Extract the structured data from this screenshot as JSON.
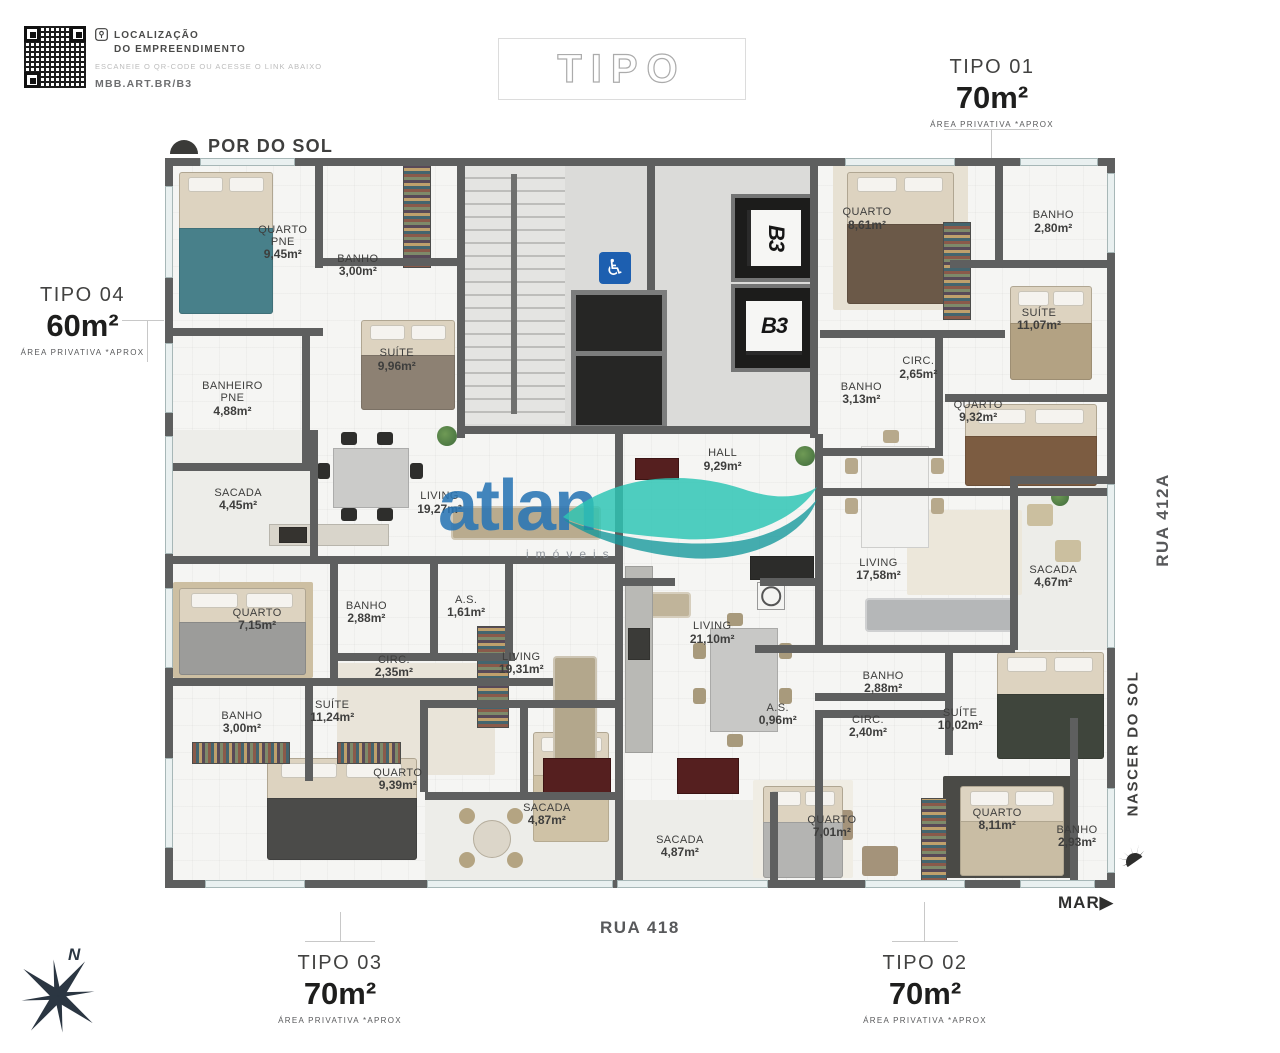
{
  "qr_block": {
    "title_line1": "LOCALIZAÇÃO",
    "title_line2": "DO EMPREENDIMENTO",
    "subtitle": "ESCANEIE O QR-CODE OU ACESSE O LINK ABAIXO",
    "link": "MBB.ART.BR/B3"
  },
  "plan_title": "TIPO",
  "unit_labels": {
    "tipo01": {
      "name": "TIPO 01",
      "area": "70m²",
      "note": "ÁREA PRIVATIVA *APROX"
    },
    "tipo02": {
      "name": "TIPO 02",
      "area": "70m²",
      "note": "ÁREA PRIVATIVA *APROX"
    },
    "tipo03": {
      "name": "TIPO 03",
      "area": "70m²",
      "note": "ÁREA PRIVATIVA *APROX"
    },
    "tipo04": {
      "name": "TIPO 04",
      "area": "60m²",
      "note": "ÁREA PRIVATIVA *APROX"
    }
  },
  "orientation": {
    "sunset_label": "POR DO SOL",
    "sunrise_label": "NASCER DO SOL",
    "sea_label": "MAR",
    "street_right": "RUA 412A",
    "street_bottom": "RUA 418",
    "compass_north": "N"
  },
  "core": {
    "elevator_brand": "B3",
    "accessible_icon": "wheelchair-symbol"
  },
  "watermark": {
    "brand": "atlan",
    "subtitle": "imóveis"
  },
  "colors": {
    "wall": "#5e5f5f",
    "accessible_blue": "#1d5fb0",
    "brand_blue": "#2a76b5",
    "wave_teal": "#2cc4b4",
    "street_gray": "#58595b"
  },
  "rooms": [
    {
      "name": "QUARTO\nPNE",
      "area": "9,45m²",
      "x": 12.4,
      "y": 11.6
    },
    {
      "name": "BANHO",
      "area": "3,00m²",
      "x": 20.3,
      "y": 14.8
    },
    {
      "name": "SUÍTE",
      "area": "9,96m²",
      "x": 24.4,
      "y": 27.7
    },
    {
      "name": "BANHEIRO\nPNE",
      "area": "4,88m²",
      "x": 7.1,
      "y": 33.0
    },
    {
      "name": "SACADA",
      "area": "4,45m²",
      "x": 7.7,
      "y": 46.8
    },
    {
      "name": "LIVING",
      "area": "19,27m²",
      "x": 28.9,
      "y": 47.3
    },
    {
      "name": "HALL",
      "area": "9,29m²",
      "x": 58.7,
      "y": 41.4
    },
    {
      "name": "QUARTO",
      "area": "8,61m²",
      "x": 73.9,
      "y": 8.4
    },
    {
      "name": "BANHO",
      "area": "2,80m²",
      "x": 93.5,
      "y": 8.8
    },
    {
      "name": "SUÍTE",
      "area": "11,07m²",
      "x": 92.0,
      "y": 22.2
    },
    {
      "name": "CIRC.",
      "area": "2,65m²",
      "x": 79.3,
      "y": 28.8
    },
    {
      "name": "BANHO",
      "area": "3,13m²",
      "x": 73.3,
      "y": 32.3
    },
    {
      "name": "QUARTO",
      "area": "9,32m²",
      "x": 85.6,
      "y": 34.8
    },
    {
      "name": "LIVING",
      "area": "17,58m²",
      "x": 75.1,
      "y": 56.4
    },
    {
      "name": "SACADA",
      "area": "4,67m²",
      "x": 93.5,
      "y": 57.4
    },
    {
      "name": "QUARTO",
      "area": "7,15m²",
      "x": 9.7,
      "y": 63.3
    },
    {
      "name": "BANHO",
      "area": "2,88m²",
      "x": 21.2,
      "y": 62.3
    },
    {
      "name": "A.S.",
      "area": "1,61m²",
      "x": 31.7,
      "y": 61.5
    },
    {
      "name": "CIRC.",
      "area": "2,35m²",
      "x": 24.1,
      "y": 69.7
    },
    {
      "name": "LIVING",
      "area": "19,31m²",
      "x": 37.5,
      "y": 69.3
    },
    {
      "name": "SUÍTE",
      "area": "11,24m²",
      "x": 17.6,
      "y": 75.9
    },
    {
      "name": "BANHO",
      "area": "3,00m²",
      "x": 8.1,
      "y": 77.4
    },
    {
      "name": "QUARTO",
      "area": "9,39m²",
      "x": 24.5,
      "y": 85.2
    },
    {
      "name": "SACADA",
      "area": "4,87m²",
      "x": 40.2,
      "y": 90.0
    },
    {
      "name": "SACADA",
      "area": "4,87m²",
      "x": 54.2,
      "y": 94.4
    },
    {
      "name": "LIVING",
      "area": "21,10m²",
      "x": 57.6,
      "y": 65.1
    },
    {
      "name": "A.S.",
      "area": "0,96m²",
      "x": 64.5,
      "y": 76.3
    },
    {
      "name": "BANHO",
      "area": "2,88m²",
      "x": 75.6,
      "y": 71.9
    },
    {
      "name": "CIRC.",
      "area": "2,40m²",
      "x": 74.0,
      "y": 77.9
    },
    {
      "name": "SUÍTE",
      "area": "10,02m²",
      "x": 83.7,
      "y": 77.0
    },
    {
      "name": "QUARTO",
      "area": "7,01m²",
      "x": 70.2,
      "y": 91.6
    },
    {
      "name": "QUARTO",
      "area": "8,11m²",
      "x": 87.6,
      "y": 90.7
    },
    {
      "name": "BANHO",
      "area": "2,93m²",
      "x": 96.0,
      "y": 93.0
    }
  ]
}
